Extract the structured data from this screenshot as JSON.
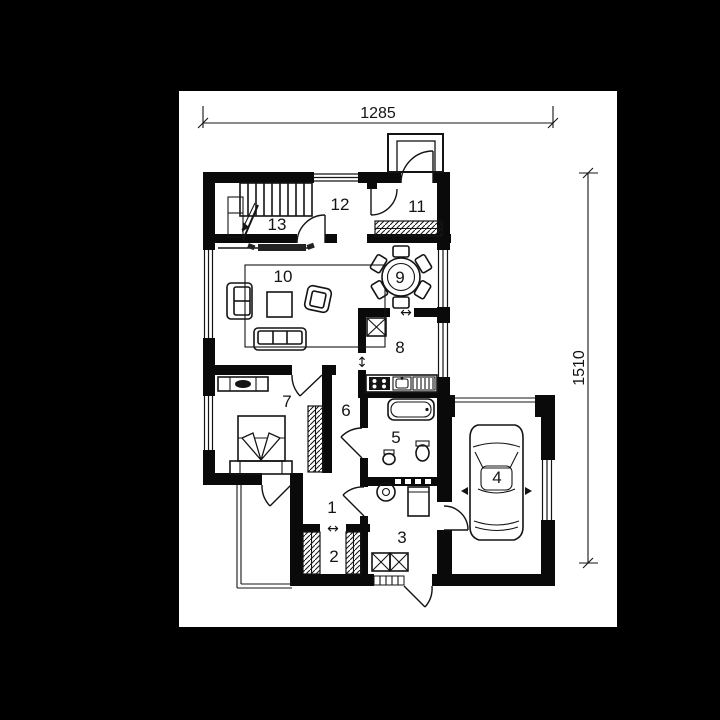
{
  "canvas": {
    "background": "#000000",
    "paper": "#ffffff",
    "ink": "#141414"
  },
  "dimensions": {
    "width_label": "1285",
    "height_label": "1510"
  },
  "rooms": [
    {
      "label": "1"
    },
    {
      "label": "2"
    },
    {
      "label": "3"
    },
    {
      "label": "4"
    },
    {
      "label": "5"
    },
    {
      "label": "6"
    },
    {
      "label": "7"
    },
    {
      "label": "8"
    },
    {
      "label": "9"
    },
    {
      "label": "10"
    },
    {
      "label": "11"
    },
    {
      "label": "12"
    },
    {
      "label": "13"
    }
  ],
  "symbols": {
    "opening_horizontal": "↔",
    "opening_vertical": "↕"
  }
}
